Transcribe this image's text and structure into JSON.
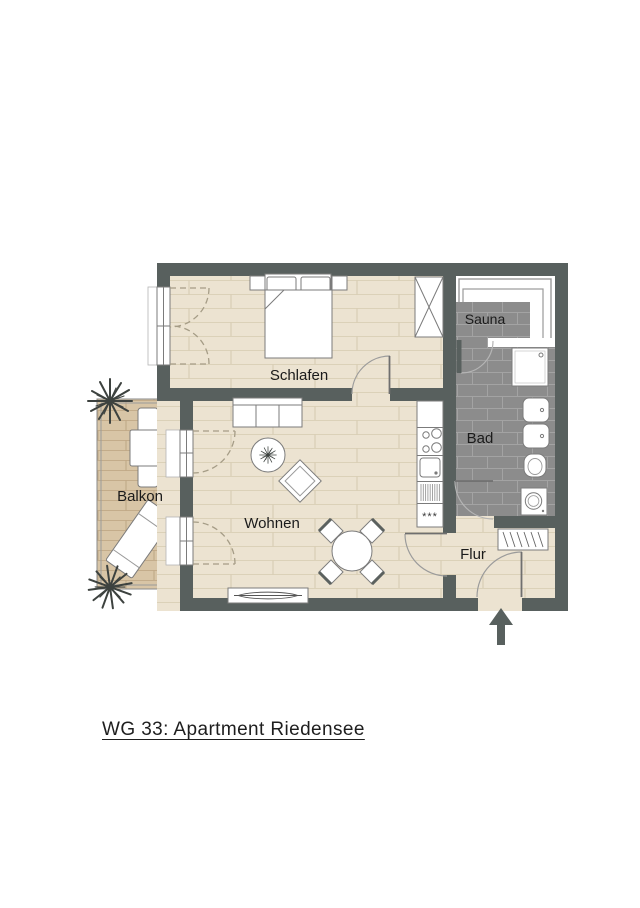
{
  "title": "WG 33: Apartment Riedensee",
  "floorplan": {
    "rooms": {
      "schlafen": {
        "label": "Schlafen"
      },
      "wohnen": {
        "label": "Wohnen"
      },
      "balkon": {
        "label": "Balkon"
      },
      "sauna": {
        "label": "Sauna"
      },
      "bad": {
        "label": "Bad"
      },
      "flur": {
        "label": "Flur"
      }
    },
    "kitchen": {
      "freezer_symbol": "***"
    },
    "colors": {
      "wall": "#58605e",
      "floor": "#ece3d1",
      "floor_line": "#dbd1b8",
      "deck": "#d8c5a6",
      "deck_line": "#c3ac8a",
      "tile": "#8c8c8c",
      "tile_grout": "#a3a3a3",
      "furniture_stroke": "#7b7b7b",
      "label_text": "#1b1b1b",
      "door_swing_dashed": "#a59c86"
    }
  }
}
